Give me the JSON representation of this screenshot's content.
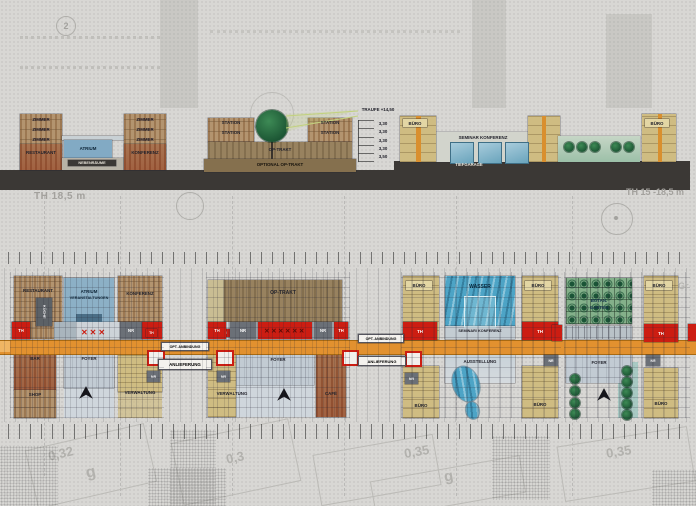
{
  "background": {
    "th_label_left": "TH 18,5 m",
    "th_label_right": "TH 15 -18,5 m",
    "circled_number": "2",
    "map_text": "Gr",
    "parcels": {
      "p1": "0,32",
      "p2": "g",
      "p3": "0,3",
      "p4": "0,35",
      "p5": "g",
      "p6": "0,35"
    }
  },
  "sections": {
    "hotel": {
      "zimmer": "ZIMMER",
      "restaurant": "RESTAURANT",
      "atrium": "ATRIUM",
      "konferenz": "KONFERENZ",
      "nebenraeume": "NEBENRÄUME"
    },
    "klinik": {
      "station": "STATION",
      "op_trakt": "OP-TRAKT",
      "optional_op": "OPTIONAL OP-TRAKT"
    },
    "dim": {
      "traufe": "TRAUFE +14,50",
      "floors": [
        "3,30",
        "3,30",
        "3,30",
        "3,30",
        "3,50"
      ]
    },
    "office": {
      "buero": "BÜRO",
      "seminar": "SEMINAR KONFERENZ",
      "tiefgarage": "TIEFGARAGE"
    }
  },
  "plans": {
    "shared": {
      "th": "TH",
      "nr": "NR",
      "opt_anbindung": "OPT. ANBINDUNG",
      "anlieferung": "ANLIEFERUNG",
      "x3": "✕✕✕",
      "x6": "✕✕✕✕✕✕"
    },
    "block1": {
      "restaurant": "RESTAURANT",
      "atrium": "ATRIUM",
      "veranstaltungen": "VERANSTALTUNGEN",
      "konferenz": "KONFERENZ",
      "kueche": "KÜCHE",
      "bar": "BAR",
      "foyer": "FOYER",
      "shop": "SHOP",
      "verwaltung": "VERWALTUNG"
    },
    "block2": {
      "op_trakt": "OP-TRAKT",
      "foyer": "FOYER",
      "verwaltung": "VERWALTUNG",
      "cafe": "CAFÉ"
    },
    "block3": {
      "buero": "BÜRO",
      "wasser": "WASSER",
      "seminar_konferenz": "SEMINAR/ KONFERENZ",
      "ausstellung": "AUSSTELLUNG"
    },
    "block4": {
      "garten_line1": "BOTAN.",
      "garten_line2": "GARTEN",
      "buero": "BÜRO",
      "foyer": "FOYER"
    }
  }
}
